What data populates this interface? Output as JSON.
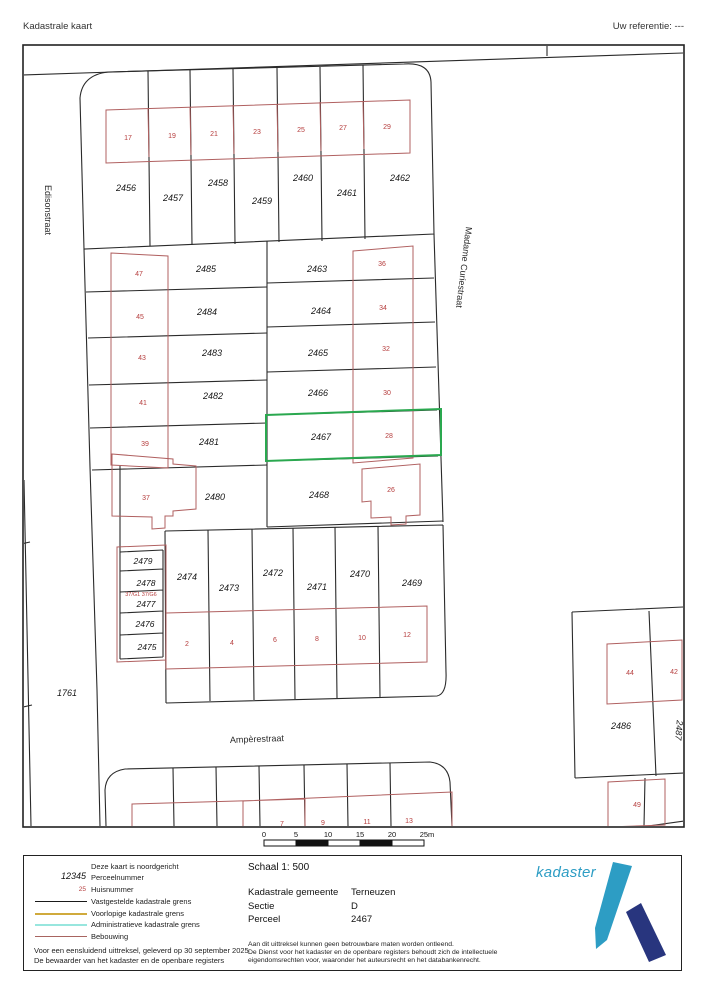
{
  "header": {
    "title": "Kadastrale kaart",
    "reference": "Uw referentie: ---"
  },
  "map": {
    "streets": {
      "left": "Edisonstraat",
      "right": "Madame Curiestraat",
      "bottom": "Ampèrestraat"
    },
    "selected_parcel": "2467",
    "parcels": [
      "2456",
      "2457",
      "2458",
      "2459",
      "2460",
      "2461",
      "2462",
      "2485",
      "2484",
      "2483",
      "2482",
      "2481",
      "2463",
      "2464",
      "2465",
      "2466",
      "2467",
      "2480",
      "2468",
      "2479",
      "2478",
      "2477",
      "2476",
      "2475",
      "2474",
      "2473",
      "2472",
      "2471",
      "2470",
      "2469",
      "2486",
      "2487",
      "1761"
    ],
    "house_numbers": [
      "17",
      "19",
      "21",
      "23",
      "25",
      "27",
      "29",
      "47",
      "45",
      "43",
      "41",
      "39",
      "36",
      "34",
      "32",
      "30",
      "28",
      "37",
      "26",
      "2",
      "4",
      "6",
      "8",
      "10",
      "12",
      "7",
      "9",
      "11",
      "13",
      "44",
      "42",
      "49"
    ],
    "garage_annotation": "37/G1 37/G6",
    "scale_bar_labels": [
      "0",
      "5",
      "10",
      "15",
      "20",
      "25m"
    ]
  },
  "legend": {
    "items": [
      {
        "sample": "",
        "label": "Deze kaart is noordgericht"
      },
      {
        "sample": "12345",
        "label": "Perceelnummer"
      },
      {
        "sample": "25",
        "label": "Huisnummer"
      },
      {
        "sample": "",
        "label": "Vastgestelde kadastrale grens"
      },
      {
        "sample": "",
        "label": "Voorlopige kadastrale grens"
      },
      {
        "sample": "",
        "label": "Administratieve kadastrale grens"
      },
      {
        "sample": "",
        "label": "Bebouwing"
      }
    ],
    "certification_line1": "Voor een eensluidend uittreksel, geleverd op 30 september 2025",
    "certification_line2": "De bewaarder van het kadaster en de openbare registers"
  },
  "info": {
    "scale": "Schaal 1: 500",
    "fields": [
      {
        "label": "Kadastrale gemeente",
        "value": "Terneuzen"
      },
      {
        "label": "Sectie",
        "value": "D"
      },
      {
        "label": "Perceel",
        "value": "2467"
      }
    ],
    "disclaimer": [
      "Aan dit uittreksel kunnen geen betrouwbare maten worden ontleend.",
      "De Dienst voor het kadaster en de openbare registers behoudt zich de intellectuele",
      "eigendomsrechten voor, waaronder het auteursrecht en het databankenrecht."
    ]
  },
  "logo": {
    "text": "kadaster"
  },
  "colors": {
    "boundary": "#2a2a2a",
    "building": "#b06060",
    "house_number": "#b63e3e",
    "selected_parcel": "#2aa84f",
    "provisional_boundary": "#d0aa3c",
    "administrative_boundary": "#98e6de",
    "logo_light": "#2d9dc4",
    "logo_dark": "#28357e"
  }
}
